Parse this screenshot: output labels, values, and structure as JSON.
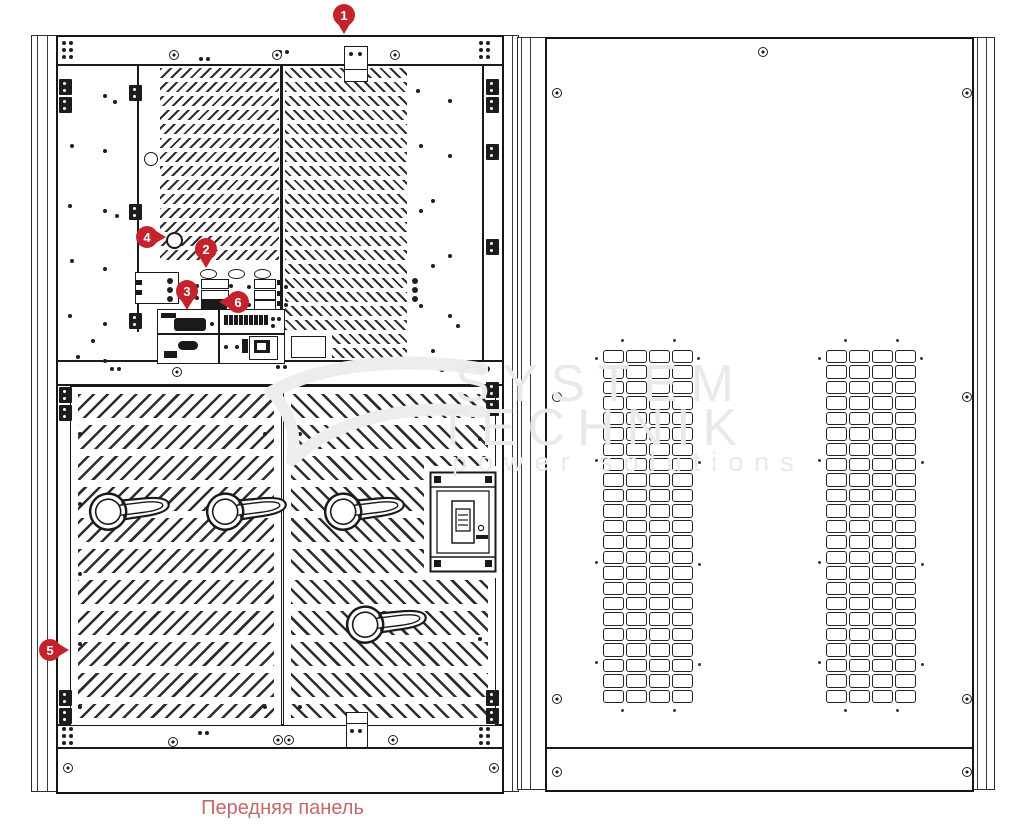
{
  "diagram": {
    "caption": "Передняя панель",
    "watermark": {
      "line1": "SYSTEM",
      "line2": "TECHNIK",
      "line3": "power solutions"
    },
    "markers": [
      {
        "label": "1"
      },
      {
        "label": "2"
      },
      {
        "label": "3"
      },
      {
        "label": "4"
      },
      {
        "label": "5"
      },
      {
        "label": "6"
      }
    ],
    "colors": {
      "marker_red": "#c5232b",
      "caption_red": "#c5686b",
      "line_black": "#1a1a1a",
      "watermark_gray": "#e9e9e9"
    }
  }
}
